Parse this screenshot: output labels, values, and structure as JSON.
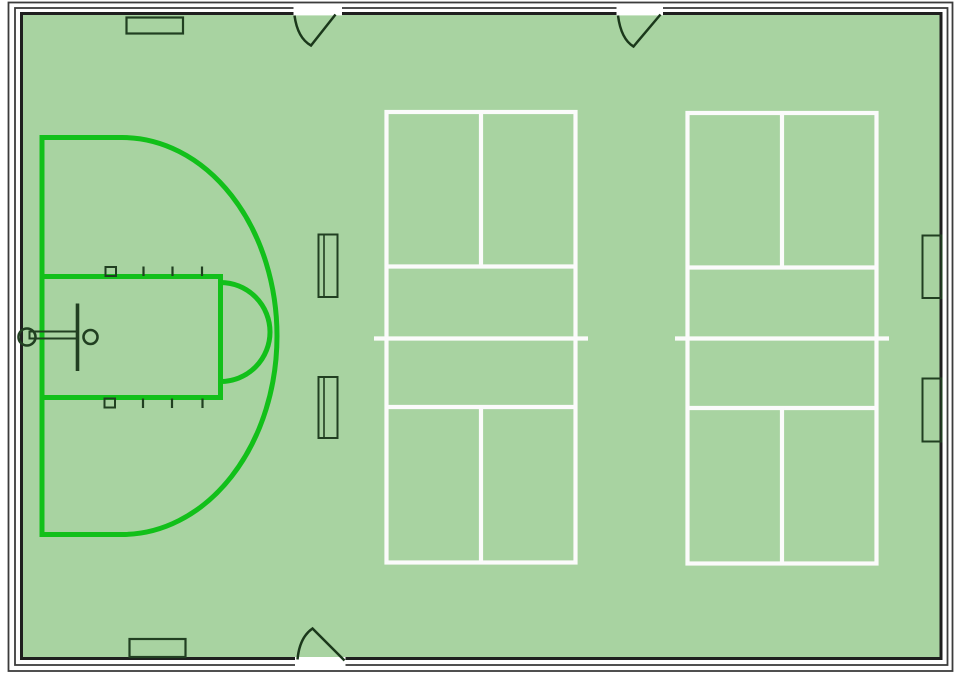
{
  "scene": {
    "width": 959,
    "height": 675,
    "background": "#ffffff"
  },
  "colors": {
    "floor": "#a8d3a1",
    "wall": "#1f1f1f",
    "wall_outer": "#3c3c3c",
    "white": "#ffffff",
    "line_white": "#fbfbfb",
    "court_green": "#12c01a",
    "fixture": "#213f21",
    "door": "#1b381b"
  },
  "shapes": [
    {
      "name": "gym-floor",
      "type": "rect",
      "attrs": {
        "x": 23,
        "y": 15,
        "width": 916.5,
        "height": 642,
        "fill": "$floor",
        "stroke": "none"
      }
    },
    {
      "name": "wall-inner-line",
      "type": "rect",
      "attrs": {
        "x": 21.5,
        "y": 13.5,
        "width": 919.5,
        "height": 645,
        "fill": "none",
        "stroke": "$wall",
        "stroke-width": 3
      }
    },
    {
      "name": "wall-middle-line",
      "type": "rect",
      "attrs": {
        "x": 15,
        "y": 8,
        "width": 932.5,
        "height": 657,
        "fill": "none",
        "stroke": "$wall_outer",
        "stroke-width": 1.8
      }
    },
    {
      "name": "wall-outer-line",
      "type": "rect",
      "attrs": {
        "x": 8.5,
        "y": 2.5,
        "width": 944,
        "height": 668.5,
        "fill": "none",
        "stroke": "$wall_outer",
        "stroke-width": 1.8
      }
    },
    {
      "name": "door-opening-top-left",
      "type": "rect",
      "attrs": {
        "x": 293.5,
        "y": 4.8,
        "width": 48.5,
        "height": 10.6,
        "fill": "$white",
        "stroke": "none"
      }
    },
    {
      "name": "door-opening-top-right",
      "type": "rect",
      "attrs": {
        "x": 616.5,
        "y": 4.8,
        "width": 46.5,
        "height": 10.6,
        "fill": "$white",
        "stroke": "none"
      }
    },
    {
      "name": "door-opening-bottom",
      "type": "rect",
      "attrs": {
        "x": 295,
        "y": 657,
        "width": 50.5,
        "height": 11,
        "fill": "$white",
        "stroke": "none"
      }
    },
    {
      "name": "door-swing-top-left",
      "type": "path",
      "attrs": {
        "d": "M 294.5 15.5 Q 297.5 38 311 45.5 L 335.5 14.5",
        "fill": "none",
        "stroke": "$door",
        "stroke-width": 2.5
      }
    },
    {
      "name": "door-swing-top-right",
      "type": "path",
      "attrs": {
        "d": "M 618 15.5 Q 621 39 633.5 46.5 L 660.5 14.5",
        "fill": "none",
        "stroke": "$door",
        "stroke-width": 2.5
      }
    },
    {
      "name": "door-swing-bottom",
      "type": "path",
      "attrs": {
        "d": "M 297.5 659.5 Q 299.5 637.5 312.5 628.5 L 344.5 660.5",
        "fill": "none",
        "stroke": "$door",
        "stroke-width": 2.5
      }
    },
    {
      "name": "pickleball-court-1-outline",
      "type": "rect",
      "attrs": {
        "x": 386.5,
        "y": 112,
        "width": 189,
        "height": 450.5,
        "fill": "none",
        "stroke": "$line_white",
        "stroke-width": 4.2
      }
    },
    {
      "name": "pickleball-court-1-centerline-top",
      "type": "line",
      "attrs": {
        "x1": 481,
        "y1": 112,
        "x2": 481,
        "y2": 266.5,
        "stroke": "$line_white",
        "stroke-width": 4.2
      }
    },
    {
      "name": "pickleball-court-1-kitchen-line-top",
      "type": "line",
      "attrs": {
        "x1": 386.5,
        "y1": 266.5,
        "x2": 575.5,
        "y2": 266.5,
        "stroke": "$line_white",
        "stroke-width": 4.2
      }
    },
    {
      "name": "pickleball-court-1-net-line",
      "type": "line",
      "attrs": {
        "x1": 374,
        "y1": 338.5,
        "x2": 588,
        "y2": 338.5,
        "stroke": "$line_white",
        "stroke-width": 4.2
      }
    },
    {
      "name": "pickleball-court-1-kitchen-line-bottom",
      "type": "line",
      "attrs": {
        "x1": 386.5,
        "y1": 407,
        "x2": 575.5,
        "y2": 407,
        "stroke": "$line_white",
        "stroke-width": 4.2
      }
    },
    {
      "name": "pickleball-court-1-centerline-bottom",
      "type": "line",
      "attrs": {
        "x1": 481,
        "y1": 407,
        "x2": 481,
        "y2": 562.5,
        "stroke": "$line_white",
        "stroke-width": 4.2
      }
    },
    {
      "name": "pickleball-court-2-outline",
      "type": "rect",
      "attrs": {
        "x": 687.5,
        "y": 113,
        "width": 189,
        "height": 450.5,
        "fill": "none",
        "stroke": "$line_white",
        "stroke-width": 4.2
      }
    },
    {
      "name": "pickleball-court-2-centerline-top",
      "type": "line",
      "attrs": {
        "x1": 782,
        "y1": 113,
        "x2": 782,
        "y2": 267.5,
        "stroke": "$line_white",
        "stroke-width": 4.2
      }
    },
    {
      "name": "pickleball-court-2-kitchen-line-top",
      "type": "line",
      "attrs": {
        "x1": 687.5,
        "y1": 267.5,
        "x2": 876.5,
        "y2": 267.5,
        "stroke": "$line_white",
        "stroke-width": 4.2
      }
    },
    {
      "name": "pickleball-court-2-net-line",
      "type": "line",
      "attrs": {
        "x1": 675,
        "y1": 338.5,
        "x2": 889,
        "y2": 338.5,
        "stroke": "$line_white",
        "stroke-width": 4.2
      }
    },
    {
      "name": "pickleball-court-2-kitchen-line-bottom",
      "type": "line",
      "attrs": {
        "x1": 687.5,
        "y1": 408,
        "x2": 876.5,
        "y2": 408,
        "stroke": "$line_white",
        "stroke-width": 4.2
      }
    },
    {
      "name": "pickleball-court-2-centerline-bottom",
      "type": "line",
      "attrs": {
        "x1": 782,
        "y1": 408,
        "x2": 782,
        "y2": 563.5,
        "stroke": "$line_white",
        "stroke-width": 4.2
      }
    },
    {
      "name": "basketball-three-point-line",
      "type": "path",
      "attrs": {
        "d": "M 42 137.5 H 122 A 155 198.5 0 0 1 122 534.5 H 42 Z",
        "fill": "none",
        "stroke": "$court_green",
        "stroke-width": 5
      }
    },
    {
      "name": "basketball-key-lines",
      "type": "path",
      "attrs": {
        "d": "M 42 276.5 H 220.5 V 397.5 H 42",
        "fill": "none",
        "stroke": "$court_green",
        "stroke-width": 5
      }
    },
    {
      "name": "basketball-free-throw-circle",
      "type": "path",
      "attrs": {
        "d": "M 220.5 282.5 A 49.5 49.5 0 0 1 220.5 381.5",
        "fill": "none",
        "stroke": "$court_green",
        "stroke-width": 5
      }
    },
    {
      "name": "lane-marker-block-top",
      "type": "rect",
      "attrs": {
        "x": 105.5,
        "y": 267,
        "width": 10.5,
        "height": 9,
        "fill": "none",
        "stroke": "$fixture",
        "stroke-width": 2
      }
    },
    {
      "name": "lane-marker-tick-top-1",
      "type": "line",
      "attrs": {
        "x1": 143.5,
        "y1": 266.5,
        "x2": 143.5,
        "y2": 276,
        "stroke": "$fixture",
        "stroke-width": 2.2
      }
    },
    {
      "name": "lane-marker-tick-top-2",
      "type": "line",
      "attrs": {
        "x1": 172.5,
        "y1": 266.5,
        "x2": 172.5,
        "y2": 276,
        "stroke": "$fixture",
        "stroke-width": 2.2
      }
    },
    {
      "name": "lane-marker-tick-top-3",
      "type": "line",
      "attrs": {
        "x1": 202,
        "y1": 266.5,
        "x2": 202,
        "y2": 276,
        "stroke": "$fixture",
        "stroke-width": 2.2
      }
    },
    {
      "name": "lane-marker-block-bottom",
      "type": "rect",
      "attrs": {
        "x": 104.5,
        "y": 398.5,
        "width": 10.5,
        "height": 9,
        "fill": "none",
        "stroke": "$fixture",
        "stroke-width": 2
      }
    },
    {
      "name": "lane-marker-tick-bottom-1",
      "type": "line",
      "attrs": {
        "x1": 143,
        "y1": 398.5,
        "x2": 143,
        "y2": 408,
        "stroke": "$fixture",
        "stroke-width": 2.2
      }
    },
    {
      "name": "lane-marker-tick-bottom-2",
      "type": "line",
      "attrs": {
        "x1": 172,
        "y1": 398.5,
        "x2": 172,
        "y2": 408,
        "stroke": "$fixture",
        "stroke-width": 2.2
      }
    },
    {
      "name": "lane-marker-tick-bottom-3",
      "type": "line",
      "attrs": {
        "x1": 202.5,
        "y1": 398.5,
        "x2": 202.5,
        "y2": 408,
        "stroke": "$fixture",
        "stroke-width": 2.2
      }
    },
    {
      "name": "basketball-hoop-wall-mount",
      "type": "circle",
      "attrs": {
        "cx": 27,
        "cy": 337,
        "r": 8.5,
        "fill": "none",
        "stroke": "$fixture",
        "stroke-width": 2.6
      }
    },
    {
      "name": "basketball-hoop-arm",
      "type": "rect",
      "attrs": {
        "x": 29.5,
        "y": 331.5,
        "width": 48,
        "height": 7,
        "fill": "none",
        "stroke": "$fixture",
        "stroke-width": 2
      }
    },
    {
      "name": "basketball-backboard",
      "type": "line",
      "attrs": {
        "x1": 77.5,
        "y1": 303.5,
        "x2": 77.5,
        "y2": 371,
        "stroke": "$fixture",
        "stroke-width": 3.6
      }
    },
    {
      "name": "basketball-rim",
      "type": "circle",
      "attrs": {
        "cx": 90.5,
        "cy": 337,
        "r": 7,
        "fill": "none",
        "stroke": "$fixture",
        "stroke-width": 2.6
      }
    },
    {
      "name": "bench-top-wall",
      "type": "rect",
      "attrs": {
        "x": 126.5,
        "y": 17.5,
        "width": 56.5,
        "height": 16,
        "fill": "none",
        "stroke": "$fixture",
        "stroke-width": 2.2
      }
    },
    {
      "name": "bench-bottom-wall",
      "type": "rect",
      "attrs": {
        "x": 129.5,
        "y": 639,
        "width": 56,
        "height": 18,
        "fill": "none",
        "stroke": "$fixture",
        "stroke-width": 2.2
      }
    },
    {
      "name": "floor-mat-upper",
      "type": "rect",
      "attrs": {
        "x": 318.5,
        "y": 234.5,
        "width": 19,
        "height": 62.5,
        "fill": "none",
        "stroke": "$fixture",
        "stroke-width": 2
      }
    },
    {
      "name": "floor-mat-upper-inner-line",
      "type": "line",
      "attrs": {
        "x1": 324,
        "y1": 234.5,
        "x2": 324,
        "y2": 297,
        "stroke": "$fixture",
        "stroke-width": 1.6
      }
    },
    {
      "name": "floor-mat-lower",
      "type": "rect",
      "attrs": {
        "x": 318.5,
        "y": 377,
        "width": 19,
        "height": 61,
        "fill": "none",
        "stroke": "$fixture",
        "stroke-width": 2
      }
    },
    {
      "name": "floor-mat-lower-inner-line",
      "type": "line",
      "attrs": {
        "x1": 324,
        "y1": 377,
        "x2": 324,
        "y2": 438,
        "stroke": "$fixture",
        "stroke-width": 1.6
      }
    },
    {
      "name": "right-wall-pad-upper",
      "type": "rect",
      "attrs": {
        "x": 922.5,
        "y": 235.5,
        "width": 19,
        "height": 62.5,
        "fill": "none",
        "stroke": "$fixture",
        "stroke-width": 2
      }
    },
    {
      "name": "right-wall-pad-lower",
      "type": "rect",
      "attrs": {
        "x": 922.5,
        "y": 378.5,
        "width": 19,
        "height": 63,
        "fill": "none",
        "stroke": "$fixture",
        "stroke-width": 2
      }
    }
  ]
}
